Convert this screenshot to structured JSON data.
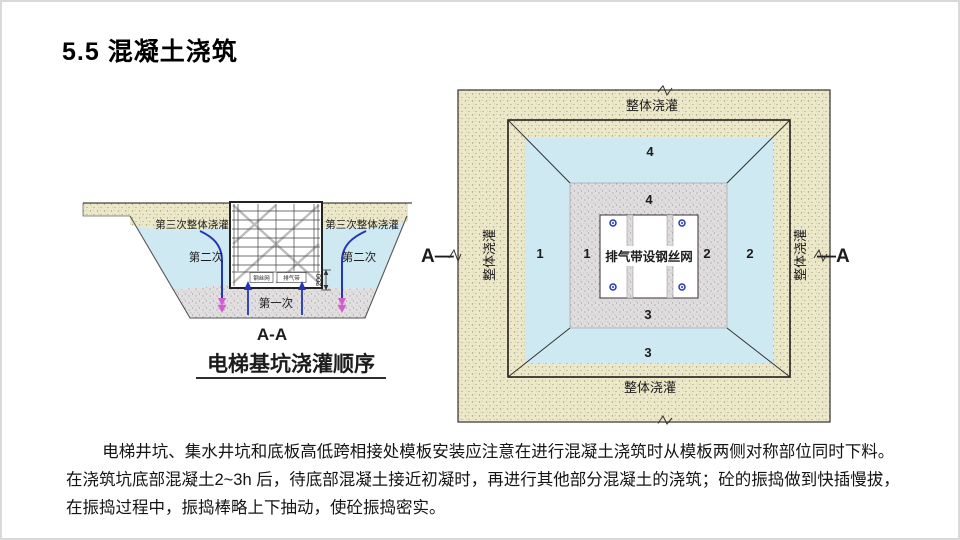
{
  "slide": {
    "title": "5.5 混凝土浇筑"
  },
  "left_diagram": {
    "third_pour_left": "第三次整体浇灌",
    "third_pour_right": "第三次整体浇灌",
    "second_pour_left": "第二次",
    "second_pour_right": "第二次",
    "first_pour": "第一次",
    "dim_200": "200",
    "formwork_label_left": "钢丝网",
    "formwork_label_right": "排气带",
    "section_mark": "A-A",
    "caption": "电梯基坑浇灌顺序"
  },
  "right_diagram": {
    "pour_top": "整体浇灌",
    "pour_bottom": "整体浇灌",
    "pour_left": "整体浇灌",
    "pour_right": "整体浇灌",
    "center_label": "排气带设钢丝网",
    "zones": {
      "z1_outer": "1",
      "z1_inner": "1",
      "z2_inner": "2",
      "z2_outer": "2",
      "z3_inner": "3",
      "z3_outer": "3",
      "z4_outer": "4",
      "z4_inner": "4"
    },
    "section_left": "A—",
    "section_right": "—A"
  },
  "paragraph": {
    "line1": "电梯井坑、集水井坑和底板高低跨相接处模板安装应注意在进行混凝土浇筑时从模板两侧对称部位同时下料。",
    "line2": "在浇筑坑底部混凝土2~3h 后，待底部混凝土接近初凝时，再进行其他部分混凝土的浇筑；砼的振捣做到快插慢拔，",
    "line3": "在振捣过程中，振捣棒略上下抽动，使砼振捣密实。"
  },
  "colors": {
    "tan_fill": "#ece8ca",
    "blue_fill": "#cfe9f2",
    "gray_fill": "#e2dfe0",
    "pipe_blue": "#2535b8",
    "magenta": "#cf5fd0",
    "ink": "#1c1c1c"
  }
}
